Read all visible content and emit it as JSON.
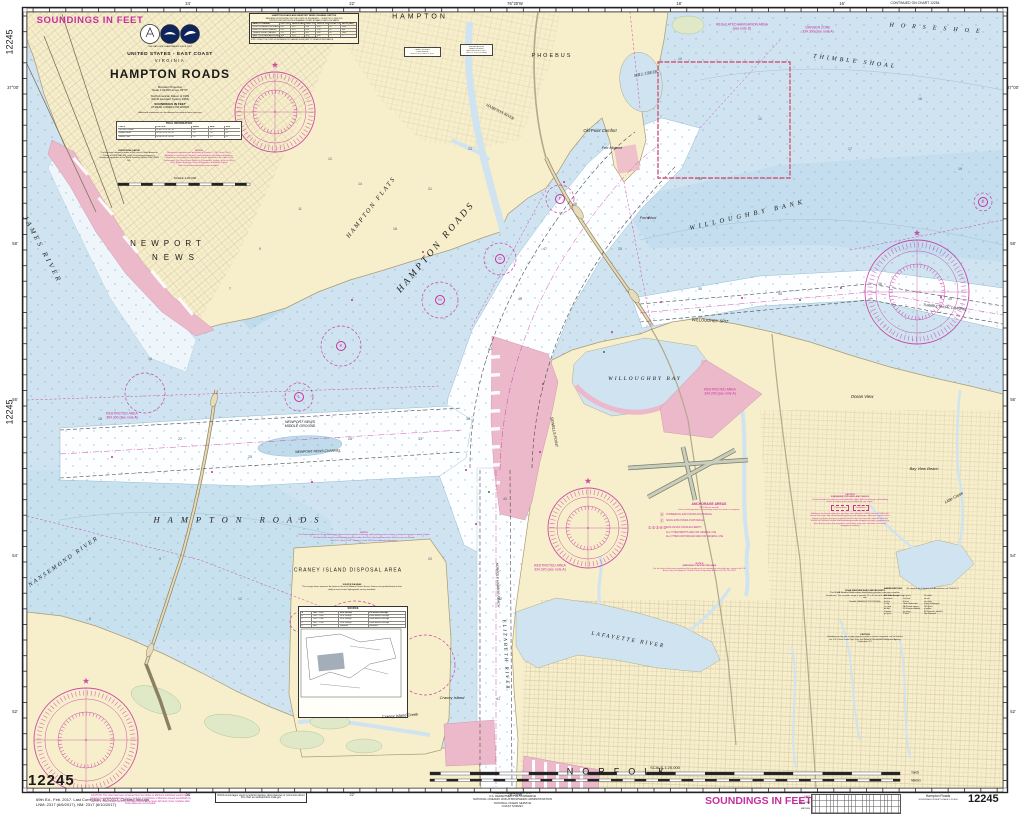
{
  "colors": {
    "magenta": "#c6309e",
    "land": "#f7eecb",
    "water": "#cfe4f0",
    "pink": "#ecb9cb",
    "deep": "#fdfeff"
  },
  "chart": {
    "number": "12245",
    "soundings_note": "SOUNDINGS IN FEET"
  },
  "title_block": {
    "tagline": "THE NATION'S CHARTMAKER SINCE 1807",
    "country": "UNITED STATES - EAST COAST",
    "state": "VIRGINIA",
    "title": "HAMPTON ROADS",
    "proj1": "Mercator Projection",
    "proj2": "Scale 1:20,000 at Lat. 36°57'",
    "datum1": "North American Datum of 1983",
    "datum2": "(World Geodetic System 1984)",
    "snd1": "SOUNDINGS IN FEET",
    "snd2": "AT MEAN LOWER LOW WATER",
    "info": "Additional information can be obtained at nauticalcharts.noaa.gov",
    "scale_label": "SCALE 1:20,000"
  },
  "tide_table": {
    "title": "TIDAL INFORMATION",
    "rows": [
      [
        "PLACE",
        "POSITION",
        "MHHW",
        "MHW",
        "MLW"
      ],
      [
        "Old Point Comfort",
        "37°00.2'N 76°18.7'W",
        "2.8",
        "2.5",
        "0.1"
      ],
      [
        "Newport News",
        "36°58.6'N 76°26.2'W",
        "2.9",
        "2.6",
        "0.1"
      ],
      [
        "Sewells Point",
        "36°56.8'N 76°19.8'W",
        "2.8",
        "2.5",
        "0.1"
      ]
    ]
  },
  "horiz_datum": {
    "title": "HORIZONTAL DATUM",
    "para": "The horizontal reference datum of this chart is North American Datum of 1983 (NAD 83), which for charting purposes is considered equivalent to the World Geodetic System 1984 (WGS 84)."
  },
  "note_a": {
    "title": "NOTE A",
    "para": "Navigation regulations are published in Chapter 2, U.S. Coast Pilot 3. Additions or revisions to Chapter 2 are published in the Notice to Mariners. Information concerning the regulations may be obtained at the Office of the Commander, 5th Coast Guard District in Portsmouth, Virginia, or at the Office of the District Engineer, Corps of Engineers in Norfolk, Virginia.",
    "tail": "Refer to charted regulation section numbers."
  },
  "channel_table": {
    "title1": "HAMPTON ROADS AND NEWPORT NEWS CHANNEL DEPTHS",
    "title2": "TABULATED FROM SURVEYS BY THE CORPS OF ENGINEERS — SURVEYS TO JUNE 2016",
    "sub": "CONTROLLING DEPTHS FROM SEAWARD IN FEET AT MEAN LOWER LOW WATER",
    "rows": [
      [
        "NAME OF CHANNEL",
        "LEFT OUTSIDE QTR",
        "MIDDLE HALF OF CHANNEL",
        "RIGHT OUTSIDE QTR",
        "DATE OF SURVEY",
        "PROJECT DEPTH",
        "WIDTH (FEET)"
      ],
      [
        "NORFOLK HARBOR ENTRANCE REACH",
        "41.2",
        "45.1",
        "43.6",
        "6/16",
        "45",
        "1000"
      ],
      [
        "NEWPORT NEWS CHANNEL",
        "43.1",
        "45.3",
        "42.8",
        "5/16",
        "45",
        "800"
      ],
      [
        "THIMBLE SHOAL CHANNEL",
        "41.9",
        "46.0",
        "44.2",
        "6/16",
        "45",
        "1000"
      ],
      [
        "HAMPTON ROADS ANCHORAGE F",
        "38.6",
        "41.0",
        "39.5",
        "4/16",
        "—",
        "—"
      ]
    ],
    "foot1": "1. (A) ALL PROJECT DEPTHS ARE AT MEAN LOWER LOW WATER. DEPTHS ARE IN FEET.",
    "foot2": "NOTE: CONSULT THE CORPS OF ENGINEERS FOR CHANGES SUBSEQUENT TO THE ABOVE INFORMATION."
  },
  "bridge_tables": {
    "b1": [
      "HAMPTON RIVER",
      "FIXED BRIDGE",
      "HOR CL 40 FT  VERT CL 10 FT"
    ],
    "b2": [
      "BRIDGES ACROSS",
      "HAMPTON RIVER",
      "BASCULE: HOR CL 50 FT",
      "VERT CL 12 FT (CLOSED)"
    ]
  },
  "anchorage_legend": {
    "title": "ANCHORAGE AREAS",
    "sub1": "110.168 (see note A)",
    "sub2": "Limits and designations of anchorage areas are shown in magenta.",
    "items": [
      [
        "Ⓐ",
        "COMMERCIAL EXPLOSIVES ANCHORAGE"
      ],
      [
        "Ⓔ",
        "NAVAL EXPLOSIVES ANCHORAGE"
      ],
      [
        "①②③④⑤",
        "EXPLOSIVES HANDLING BERTH"
      ],
      [
        "",
        "ALL OTHER BERTHS ARE FOR GENERAL USE"
      ],
      [
        "",
        "ALL OTHER ANCHORAGES ARE FOR GENERAL USE"
      ]
    ]
  },
  "note_e": {
    "title": "NOTE E",
    "sub": "EMERGENCY RESTRICTED AREA",
    "para": "For the latest information regarding the boundaries of an emergency restricted area, contact the U.S. Army Corps of Engineers, Norfolk District Regulatory Branch at (757) 201-7652."
  },
  "craney_note": {
    "title": "NOTE D",
    "para1": "The Restricted Area at Craney Island spoil disposal area contains numerous spoil pipelines and is subject to frequent changes in depth. Depths of 6 feet or less may be encountered anywhere within this area. Spoil pipelines within the area are not charted.",
    "para2": "See U.S. Coast Pilot 3, Chapter 2, chart 12253 for additional information."
  },
  "source_diagram": {
    "para_title": "SOURCE DIAGRAM",
    "para": "The surveys shown represent the latest on file at the National Ocean Service. Sources are graded based on their ability to meet current hydrographic survey standards.",
    "table_title": "SOURCE",
    "rows": [
      [
        "A",
        "1981 – 2013",
        "NOS Surveys",
        "Full bottom coverage"
      ],
      [
        "B",
        "1962 – 2009",
        "NOS Surveys",
        "Partial bottom coverage"
      ],
      [
        "C",
        "1939 – 1968",
        "NOS Surveys",
        "Partial bottom coverage"
      ],
      [
        "D",
        "1887 – 1938",
        "NOS Surveys",
        "Partial bottom coverage"
      ],
      [
        "E",
        "Misc.",
        "Reported",
        "Unverified"
      ]
    ]
  },
  "pipeline_caution": {
    "title": "CAUTION",
    "sub": "SUBMARINE PIPELINES AND CABLES",
    "para1": "Charted submarine pipelines and submarine cables within anchorage and berthing areas, or where routes are established, are shown.",
    "boxes": {
      "0": "Pipeline Area",
      "1": "Cable Area"
    },
    "para2": "Additional uncharted submarine pipelines and submarine cables may exist within the area of this chart. Not all submarine pipelines and submarine cables are required to be buried, and those that were originally buried may have become exposed. Mariners should use extreme caution when operating vessels in depths of water comparable to their draft in areas where pipelines and cables may exist, and when anchoring, dragging or trawling."
  },
  "weather_note": {
    "title": "NOAA WEATHER RADIO BROADCASTS",
    "para": "The NOAA Weather Radio station listed below provides continuous weather broadcasts. The reception range is typically 20 to 40 nautical miles from the antenna site.",
    "station": "Norfolk, VA      KHB-37      162.550 MHz"
  },
  "radio_caution": {
    "title": "CAUTION",
    "para": "Limitations on the use of radio signals as aids to marine navigation can be found in the U.S. Coast Guard Light Lists and National Geospatial-Intelligence Agency Publication 117."
  },
  "abbreviations": {
    "title": "ABBREVIATIONS",
    "note": "(For complete list of Symbols and Abbreviations, see Chart No. 1)",
    "col1": [
      "ANCH  Anchorage",
      "bk  broken",
      "bu  blue",
      "cl  clay",
      "Co  coral",
      "dk  dark",
      "G  gravel",
      "gn  green"
    ],
    "col2": [
      "grs  grass",
      "hrd  hard",
      "M  mud",
      "Obstr  Obstruction",
      "PA  Position approx",
      "PD  Position doubtful",
      "rky  rocky",
      "S  sand"
    ],
    "col3": [
      "Sh  shells",
      "sft  soft",
      "stk  sticky",
      "Subm  Submerged",
      "Wk  Wreck",
      "yl  yellow",
      "ED  Existence doubtful",
      "Rep  Reported"
    ]
  },
  "margin": {
    "edition": "69th Ed., Feb. 2017. Last Correction: 6/7/2017. Cleared through\nLNM: 2317 (6/6/2017), NM: 2317 (6/10/2017)",
    "caution": "CAUTION: This chart has been corrected from the Notice to Mariners published weekly by the National Geospatial-Intelligence Agency and the Local Notice to Mariners issued periodically by each U.S. Coast Guard district to the dates shown in the lower left hand corner. Updates after those dates are not included.",
    "inquiry": "NOAA encourages users to submit inquiries, discrepancies or comments about this chart at nauticalcharts.noaa.gov",
    "publisher": "Published at Washington, D.C.\nU.S. DEPARTMENT OF COMMERCE\nNATIONAL OCEANIC AND ATMOSPHERIC ADMINISTRATION\nNATIONAL OCEAN SERVICE\nCOAST SURVEY",
    "soundings": "SOUNDINGS IN FEET",
    "conv_rows": [
      "FEET",
      "FATHOMS",
      "METERS"
    ],
    "mini_title": "Hampton Roads",
    "mini_sub": "SOUNDINGS IN FEET   SCALE 1:20,000"
  },
  "map_labels": [
    {
      "t": "SOUNDINGS IN FEET",
      "x": 90,
      "y": 21,
      "fs": 9.5,
      "b": 1,
      "col": "M",
      "ls": 0.6
    },
    {
      "t": "HAMPTON",
      "x": 420,
      "y": 17,
      "fs": 7,
      "ls": 3
    },
    {
      "t": "PHOEBUS",
      "x": 552,
      "y": 57,
      "fs": 5.5,
      "ls": 2
    },
    {
      "t": "NEWPORT",
      "x": 168,
      "y": 244,
      "fs": 8,
      "ls": 5
    },
    {
      "t": "NEWS",
      "x": 176,
      "y": 258,
      "fs": 8,
      "ls": 6
    },
    {
      "t": "NORFOLK",
      "x": 620,
      "y": 772,
      "fs": 9,
      "ls": 9
    },
    {
      "t": "HAMPTON  FLATS",
      "x": 372,
      "y": 208,
      "fs": 6.5,
      "rot": -52,
      "it": 1,
      "sf": 1,
      "ls": 2
    },
    {
      "t": "HAMPTON   ROADS",
      "x": 437,
      "y": 248,
      "fs": 9.5,
      "rot": -50,
      "it": 1,
      "sf": 1,
      "ls": 3
    },
    {
      "t": "HAMPTON   ROADS",
      "x": 240,
      "y": 520,
      "fs": 8.5,
      "it": 1,
      "sf": 1,
      "ls": 8
    },
    {
      "t": "WILLOUGHBY  BANK",
      "x": 748,
      "y": 216,
      "fs": 6.5,
      "rot": -13,
      "it": 1,
      "sf": 1,
      "ls": 4
    },
    {
      "t": "THIMBLE  SHOAL",
      "x": 855,
      "y": 62,
      "fs": 6,
      "rot": 7,
      "it": 1,
      "sf": 1,
      "ls": 3
    },
    {
      "t": "HORSESHOE",
      "x": 938,
      "y": 29,
      "fs": 6,
      "rot": 4,
      "it": 1,
      "sf": 1,
      "ls": 7
    },
    {
      "t": "THIMBLE SHOAL CHANNEL",
      "x": 945,
      "y": 308,
      "fs": 3.4,
      "rot": 6,
      "it": 1
    },
    {
      "t": "JAMES  RIVER",
      "x": 42,
      "y": 250,
      "fs": 7,
      "rot": 62,
      "it": 1,
      "sf": 1,
      "ls": 3
    },
    {
      "t": "NANSEMOND  RIVER",
      "x": 64,
      "y": 562,
      "fs": 6,
      "rot": -35,
      "it": 1,
      "sf": 1,
      "ls": 2
    },
    {
      "t": "ELIZABETH  RIVER",
      "x": 505,
      "y": 655,
      "fs": 5,
      "rot": 87,
      "it": 1,
      "sf": 1,
      "ls": 2
    },
    {
      "t": "LAFAYETTE  RIVER",
      "x": 628,
      "y": 641,
      "fs": 5.5,
      "rot": 10,
      "it": 1,
      "sf": 1,
      "ls": 2
    },
    {
      "t": "MILL CREEK",
      "x": 646,
      "y": 74,
      "fs": 4.2,
      "rot": -10,
      "it": 1,
      "sf": 1
    },
    {
      "t": "WILLOUGHBY  BAY",
      "x": 645,
      "y": 380,
      "fs": 5.5,
      "it": 1,
      "sf": 1,
      "ls": 2
    },
    {
      "t": "WILLOUGHBY SPIT",
      "x": 710,
      "y": 321,
      "fs": 4,
      "rot": 3,
      "it": 1
    },
    {
      "t": "Old Point Comfort",
      "x": 600,
      "y": 131,
      "fs": 4.2,
      "it": 1
    },
    {
      "t": "Fort Monroe",
      "x": 612,
      "y": 148,
      "fs": 3.8,
      "it": 1
    },
    {
      "t": "Fort Wool",
      "x": 648,
      "y": 218,
      "fs": 3.8,
      "it": 1
    },
    {
      "t": "Ocean View",
      "x": 862,
      "y": 397,
      "fs": 4.2,
      "it": 1
    },
    {
      "t": "Bay View Beach",
      "x": 924,
      "y": 469,
      "fs": 4,
      "it": 1
    },
    {
      "t": "Little Creek",
      "x": 954,
      "y": 498,
      "fs": 4,
      "rot": -28,
      "it": 1
    },
    {
      "t": "Craney Island",
      "x": 452,
      "y": 698,
      "fs": 4,
      "it": 1
    },
    {
      "t": "CRANEY ISLAND DISPOSAL AREA",
      "x": 348,
      "y": 571,
      "fs": 5,
      "ls": 1
    },
    {
      "t": "Craney Island Creek",
      "x": 400,
      "y": 716,
      "fs": 4,
      "rot": -4,
      "it": 1
    },
    {
      "t": "NEWPORT NEWS\nMIDDLE GROUND",
      "x": 300,
      "y": 425,
      "fs": 3.6,
      "it": 1,
      "pre": 1
    },
    {
      "t": "HAMPTON RIVER",
      "x": 500,
      "y": 112,
      "fs": 4,
      "rot": 27,
      "it": 1,
      "sf": 1
    },
    {
      "t": "SEWELLS POINT",
      "x": 554,
      "y": 432,
      "fs": 3.8,
      "rot": 80,
      "it": 1
    },
    {
      "t": "NEWPORT NEWS CHANNEL",
      "x": 318,
      "y": 452,
      "fs": 3.4,
      "rot": -2,
      "it": 1
    },
    {
      "t": "NORFOLK HARBOR REACH",
      "x": 497,
      "y": 585,
      "fs": 3.4,
      "rot": 88,
      "it": 1
    },
    {
      "t": "RESTRICTED AREA\n334.300 (see note A)",
      "x": 122,
      "y": 416,
      "fs": 3.4,
      "col": "M",
      "pre": 1
    },
    {
      "t": "RESTRICTED AREA\n334.320 (see note A)",
      "x": 550,
      "y": 568,
      "fs": 3.4,
      "col": "M",
      "pre": 1
    },
    {
      "t": "RESTRICTED AREA\n334.290 (see note A)",
      "x": 720,
      "y": 392,
      "fs": 3.4,
      "col": "M",
      "pre": 1
    },
    {
      "t": "REGULATED NAVIGATION AREA\n(see note D)",
      "x": 742,
      "y": 27,
      "fs": 3.4,
      "col": "M",
      "pre": 1
    },
    {
      "t": "DANGER ZONE\n334.300 (see note A)",
      "x": 818,
      "y": 30,
      "fs": 3.4,
      "col": "M",
      "pre": 1
    },
    {
      "t": "F",
      "x": 560,
      "y": 199,
      "fs": 4.5,
      "circ": 1,
      "col": "M"
    },
    {
      "t": "G",
      "x": 500,
      "y": 259,
      "fs": 4.5,
      "circ": 1,
      "col": "M"
    },
    {
      "t": "H",
      "x": 440,
      "y": 300,
      "fs": 4.5,
      "circ": 1,
      "col": "M"
    },
    {
      "t": "K",
      "x": 341,
      "y": 346,
      "fs": 4.5,
      "circ": 1,
      "col": "M"
    },
    {
      "t": "L",
      "x": 299,
      "y": 397,
      "fs": 4.5,
      "circ": 1,
      "col": "M"
    },
    {
      "t": "E",
      "x": 983,
      "y": 202,
      "fs": 4.5,
      "circ": 1,
      "col": "M"
    },
    {
      "t": "12245",
      "x": 10,
      "y": 42,
      "fs": 9,
      "rot": -90
    },
    {
      "t": "12245",
      "x": 10,
      "y": 412,
      "fs": 9,
      "rot": -90
    },
    {
      "t": "24'",
      "x": 188,
      "y": 4,
      "fs": 4.2
    },
    {
      "t": "22'",
      "x": 352,
      "y": 4,
      "fs": 4.2
    },
    {
      "t": "76°20'W",
      "x": 515,
      "y": 4,
      "fs": 4.2
    },
    {
      "t": "18'",
      "x": 679,
      "y": 4,
      "fs": 4.2
    },
    {
      "t": "16'",
      "x": 842,
      "y": 4,
      "fs": 4.2
    },
    {
      "t": "CONTINUED ON CHART 12254",
      "x": 915,
      "y": 4,
      "fs": 3.4
    },
    {
      "t": "24'",
      "x": 188,
      "y": 795,
      "fs": 3.8
    },
    {
      "t": "22'",
      "x": 352,
      "y": 795,
      "fs": 3.8
    },
    {
      "t": "76°20'W",
      "x": 515,
      "y": 795,
      "fs": 3.8
    },
    {
      "t": "37°00'",
      "x": 13,
      "y": 88,
      "fs": 4.2
    },
    {
      "t": "58'",
      "x": 15,
      "y": 244,
      "fs": 4.2
    },
    {
      "t": "56'",
      "x": 15,
      "y": 400,
      "fs": 4.2
    },
    {
      "t": "54'",
      "x": 15,
      "y": 556,
      "fs": 4.2
    },
    {
      "t": "52'",
      "x": 15,
      "y": 712,
      "fs": 4.2
    },
    {
      "t": "37°00'",
      "x": 1013,
      "y": 88,
      "fs": 4.2
    },
    {
      "t": "58'",
      "x": 1013,
      "y": 244,
      "fs": 4.2
    },
    {
      "t": "56'",
      "x": 1013,
      "y": 400,
      "fs": 4.2
    },
    {
      "t": "54'",
      "x": 1013,
      "y": 556,
      "fs": 4.2
    },
    {
      "t": "52'",
      "x": 1013,
      "y": 712,
      "fs": 4.2
    },
    {
      "t": "SCALE 1:20,000",
      "x": 665,
      "y": 768,
      "fs": 4
    },
    {
      "t": "Yards",
      "x": 915,
      "y": 773,
      "fs": 3.2,
      "it": 1
    },
    {
      "t": "Meters",
      "x": 916,
      "y": 781,
      "fs": 3.2,
      "it": 1
    }
  ],
  "soundings": [
    {
      "t": "12",
      "x": 330,
      "y": 160
    },
    {
      "t": "14",
      "x": 360,
      "y": 185
    },
    {
      "t": "11",
      "x": 300,
      "y": 210
    },
    {
      "t": "9",
      "x": 260,
      "y": 250
    },
    {
      "t": "7",
      "x": 230,
      "y": 290
    },
    {
      "t": "18",
      "x": 395,
      "y": 230
    },
    {
      "t": "21",
      "x": 430,
      "y": 190
    },
    {
      "t": "23",
      "x": 470,
      "y": 150
    },
    {
      "t": "15",
      "x": 150,
      "y": 360
    },
    {
      "t": "18",
      "x": 100,
      "y": 420
    },
    {
      "t": "22",
      "x": 180,
      "y": 440
    },
    {
      "t": "25",
      "x": 250,
      "y": 458
    },
    {
      "t": "28",
      "x": 350,
      "y": 440
    },
    {
      "t": "33",
      "x": 420,
      "y": 440
    },
    {
      "t": "45",
      "x": 520,
      "y": 300
    },
    {
      "t": "47",
      "x": 545,
      "y": 250
    },
    {
      "t": "46",
      "x": 575,
      "y": 205
    },
    {
      "t": "42",
      "x": 490,
      "y": 350
    },
    {
      "t": "38",
      "x": 468,
      "y": 420
    },
    {
      "t": "40",
      "x": 505,
      "y": 500
    },
    {
      "t": "42",
      "x": 500,
      "y": 600
    },
    {
      "t": "41",
      "x": 498,
      "y": 700
    },
    {
      "t": "30",
      "x": 700,
      "y": 290
    },
    {
      "t": "45",
      "x": 780,
      "y": 295
    },
    {
      "t": "46",
      "x": 880,
      "y": 285
    },
    {
      "t": "45",
      "x": 950,
      "y": 300
    },
    {
      "t": "15",
      "x": 700,
      "y": 180
    },
    {
      "t": "12",
      "x": 760,
      "y": 120
    },
    {
      "t": "17",
      "x": 850,
      "y": 150
    },
    {
      "t": "18",
      "x": 920,
      "y": 100
    },
    {
      "t": "19",
      "x": 960,
      "y": 170
    },
    {
      "t": "10",
      "x": 680,
      "y": 60
    },
    {
      "t": "12",
      "x": 240,
      "y": 600
    },
    {
      "t": "9",
      "x": 160,
      "y": 560
    },
    {
      "t": "6",
      "x": 90,
      "y": 620
    },
    {
      "t": "15",
      "x": 300,
      "y": 520
    },
    {
      "t": "20",
      "x": 430,
      "y": 560
    },
    {
      "t": "25",
      "x": 620,
      "y": 250
    }
  ]
}
